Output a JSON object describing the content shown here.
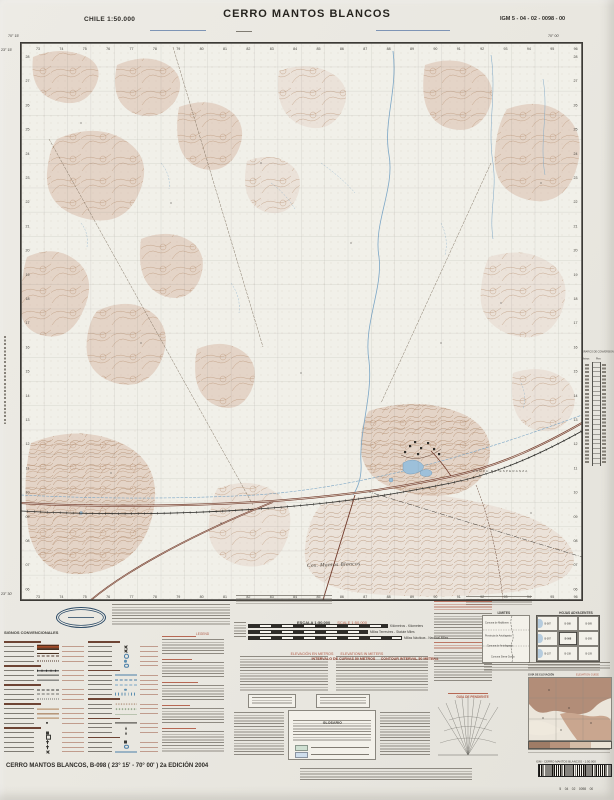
{
  "header": {
    "country_scale": "CHILE  1:50.000",
    "title": "CERRO MANTOS BLANCOS",
    "sheet_code": "IGM 5 - 04 - 02 - 0098 - 00"
  },
  "map": {
    "corners": {
      "lon_w": "70° 15'",
      "lon_e": "70° 00'",
      "lat_n": "23° 15'",
      "lat_s": "23° 30'"
    },
    "grid": {
      "top_labels": [
        "73",
        "74",
        "75",
        "76",
        "77",
        "78",
        "79",
        "80",
        "81",
        "82",
        "83",
        "84",
        "85",
        "86",
        "87",
        "88",
        "89",
        "90",
        "91",
        "92",
        "93",
        "94",
        "95",
        "96"
      ],
      "left_labels": [
        "28",
        "27",
        "26",
        "25",
        "24",
        "23",
        "22",
        "21",
        "20",
        "19",
        "18",
        "17",
        "16",
        "15",
        "14",
        "13",
        "12",
        "11",
        "10",
        "09",
        "08",
        "07",
        "06"
      ]
    },
    "labels": {
      "range": "Cos. Mantos Blancos",
      "pampa": "PAMPA DE ESPERANZA"
    }
  },
  "margins": {
    "conversion": {
      "title": "GRÁFICO DE CONVERSIÓN",
      "unit_left": "Metros",
      "unit_right": "Pies"
    }
  },
  "legend": {
    "signos": {
      "title": "SIGNOS CONVENCIONALES",
      "en": "LEGEND"
    },
    "symbols": {
      "colA": [
        "heading",
        "paved-road",
        "gravel-road",
        "track",
        "trail",
        "heading",
        "railway",
        "power-line",
        "fence",
        "heading",
        "international-boundary",
        "regional-boundary",
        "communal-boundary",
        "heading",
        "contour-line",
        "index-contour",
        "depression-contour",
        "spot-height",
        "heading",
        "building",
        "ruin",
        "church",
        "cemetery",
        "mine"
      ],
      "colB": [
        "heading",
        "mine",
        "quarry",
        "well",
        "water-tank",
        "windmill",
        "heading",
        "canal",
        "aqueduct",
        "intermittent-stream",
        "waterhole",
        "marsh",
        "heading",
        "sand",
        "scrub",
        "cultivated-land",
        "heading",
        "airfield",
        "antenna",
        "triangulation-point",
        "heading",
        "building",
        "well",
        "canal"
      ]
    },
    "scale": {
      "es": "ESCALA 1:50.000",
      "en": "SCALE 1:50.000",
      "bars": [
        "Kilómetros - Kilometers",
        "Millas Terrestres - Statute Miles",
        "Millas Náuticas - Nautical Miles"
      ]
    },
    "elevation": {
      "es": "ELEVACIÓN EN METROS",
      "en": "ELEVATIONS IN METERS",
      "interval_es": "INTERVALO DE CURVAS 50 METROS",
      "interval_en": "CONTOUR INTERVAL 50 METERS"
    },
    "glossary": {
      "title": "GLOSARIO"
    },
    "limits": {
      "es": "LÍMITES",
      "en": "BOUNDARIES",
      "items": [
        "Comuna de Mejillones",
        "Provincia de Antofagasta",
        "Comuna de Antofagasta",
        "Comuna Sierra Gorda"
      ]
    },
    "adjoining": {
      "es": "HOJAS ADYACENTES",
      "en": "ADJOINING SHEETS",
      "sheets": [
        [
          "B-087",
          "B-088",
          "B-089"
        ],
        [
          "B-097",
          "B-098",
          "B-099"
        ],
        [
          "B-107",
          "B-108",
          "B-109"
        ]
      ]
    },
    "slope": {
      "title": "GUÍA DE PENDIENTE"
    },
    "elev_guide": {
      "es": "GUÍA DE ELEVACIÓN",
      "en": "ELEVATION GUIDE"
    }
  },
  "footer": {
    "sheet_line": "CERRO MANTOS BLANCOS, B-098 ( 23° 15' - 70° 00' )  2a EDICIÓN 2004",
    "barcode_label": "IGM  - CERRO MANTOS BLANCOS -  1:50.000",
    "barcode_digits": "5    04    02    0098    00"
  },
  "colors": {
    "accent_red": "#b05a45",
    "terrain_tan": "#d8b7a5",
    "contour_brown": "#b68e6e",
    "water_blue": "#7ba6c6",
    "road_red": "#a24c2a",
    "ink": "#3c3a36"
  }
}
